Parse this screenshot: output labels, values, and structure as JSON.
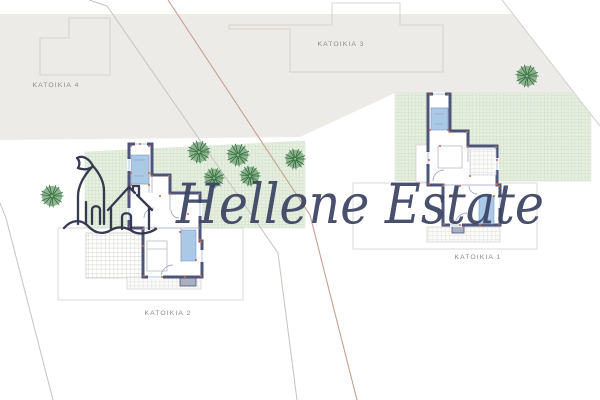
{
  "document": {
    "kind": "architectural site plan with floor plans",
    "background": "#ffffff"
  },
  "watermark": {
    "text": "Hellene Estate",
    "color": "#3c4363",
    "logo": "hand-drawn-castle-and-house-over-wave"
  },
  "labels": {
    "katoikia1": "KATOIKIA 1",
    "katoikia2": "KATOIKIA 2",
    "katoikia3": "KATOIKIA 3",
    "katoikia4": "KATOIKIA 4",
    "color": "#8f8c87"
  },
  "colors": {
    "neighbor_area_gray": "#ecebe7",
    "garden_green": "#e7efe0",
    "garden_grid_line": "#cdddc6",
    "wall_navy": "#4c5479",
    "bathroom_blue": "#aac9e7",
    "dimension_orange": "#d2693e",
    "outline_gray": "#cfccc6",
    "boundary_gray": "#c6c3bd",
    "boundary_brown": "#c7a090",
    "tree_fill": "#7fa983",
    "tree_spokes": "#2f6b3a"
  },
  "trees": {
    "positions": [
      [
        52,
        196,
        11
      ],
      [
        199,
        152,
        11
      ],
      [
        238,
        155,
        11
      ],
      [
        214,
        178,
        10
      ],
      [
        250,
        176,
        10
      ],
      [
        295,
        159,
        10
      ],
      [
        527,
        76,
        11
      ]
    ]
  },
  "dim_marks": {
    "plan2": [
      [
        131,
        146
      ],
      [
        149,
        146
      ],
      [
        140,
        144
      ],
      [
        131,
        173
      ],
      [
        149,
        173
      ],
      [
        131,
        185
      ],
      [
        149,
        185
      ],
      [
        152,
        176
      ],
      [
        169,
        176
      ],
      [
        170,
        194
      ],
      [
        199,
        194
      ],
      [
        200,
        240
      ],
      [
        201,
        242
      ],
      [
        201,
        276
      ],
      [
        185,
        277
      ],
      [
        162,
        277
      ],
      [
        144,
        276
      ],
      [
        143,
        246
      ],
      [
        143,
        229
      ],
      [
        130,
        227
      ],
      [
        130,
        194
      ],
      [
        155,
        228
      ],
      [
        180,
        232
      ],
      [
        196,
        260
      ],
      [
        188,
        214
      ],
      [
        160,
        196
      ]
    ],
    "plan1": [
      [
        430,
        95
      ],
      [
        448,
        95
      ],
      [
        430,
        130
      ],
      [
        448,
        130
      ],
      [
        450,
        132
      ],
      [
        467,
        132
      ],
      [
        468,
        147
      ],
      [
        496,
        147
      ],
      [
        497,
        160
      ],
      [
        497,
        184
      ],
      [
        499,
        186
      ],
      [
        499,
        224
      ],
      [
        480,
        225
      ],
      [
        460,
        225
      ],
      [
        444,
        224
      ],
      [
        443,
        200
      ],
      [
        443,
        186
      ],
      [
        429,
        184
      ],
      [
        429,
        160
      ],
      [
        440,
        146
      ],
      [
        470,
        176
      ],
      [
        494,
        196
      ],
      [
        460,
        186
      ]
    ]
  }
}
